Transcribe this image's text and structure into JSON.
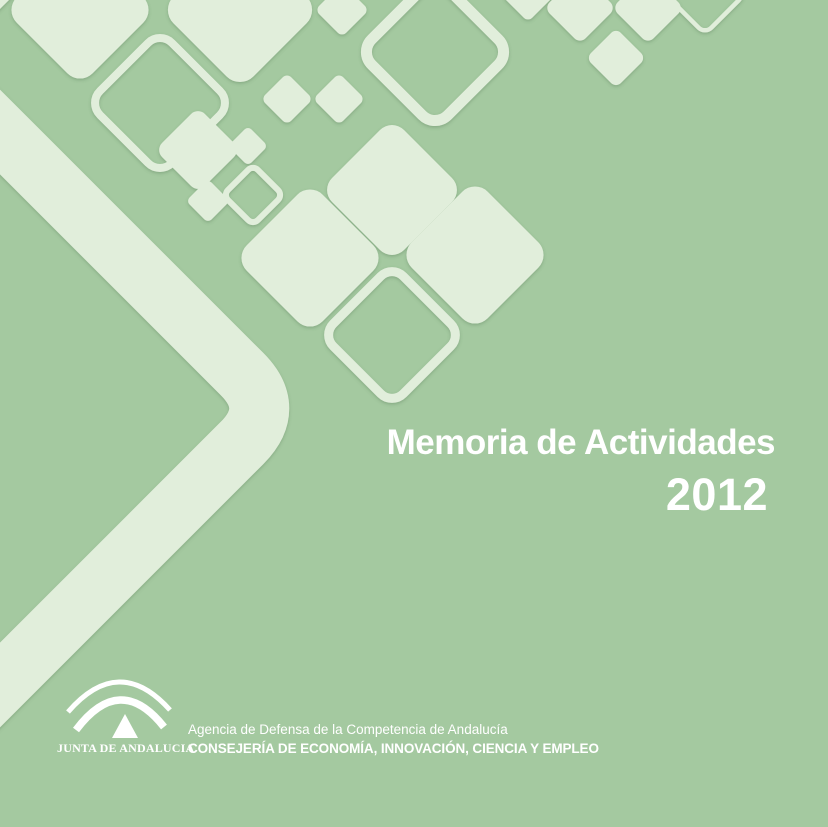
{
  "cover": {
    "title": "Memoria de Actividades",
    "year": "2012"
  },
  "footer": {
    "logo_caption": "JUNTA DE ANDALUCIA",
    "agency": "Agencia de Defensa de la Competencia de Andalucía",
    "department": "CONSEJERÍA DE ECONOMÍA, INNOVACIÓN, CIENCIA Y EMPLEO"
  },
  "colors": {
    "background": "#a4c9a0",
    "shape_light": "#e1eedb",
    "text": "#ffffff"
  }
}
